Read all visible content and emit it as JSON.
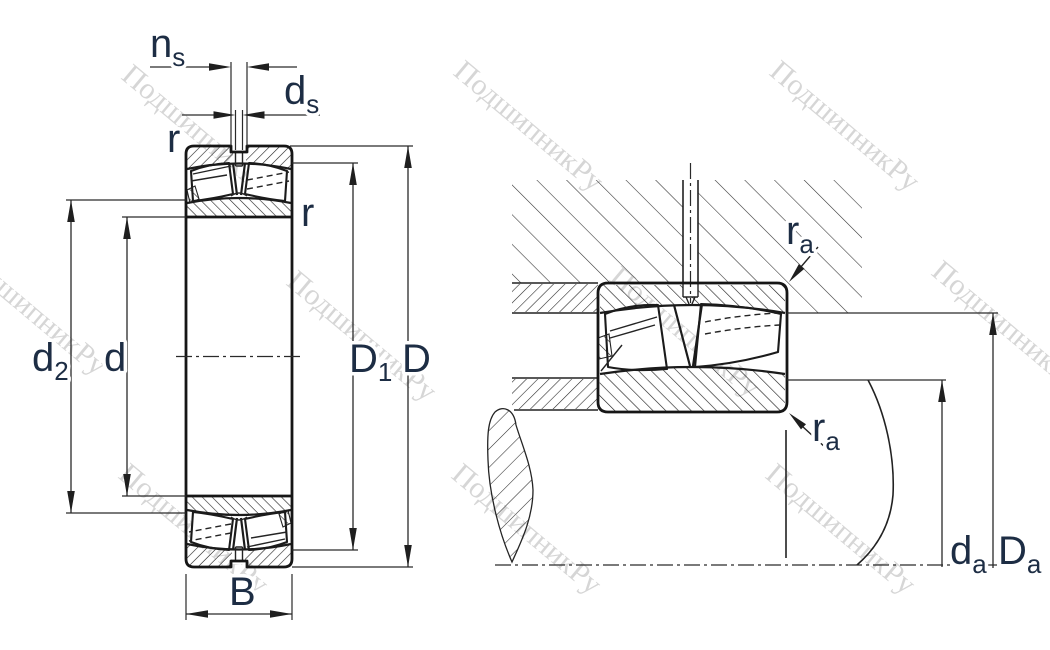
{
  "drawing": {
    "left_view": "bearing-cross-section",
    "right_view": "bearing-mounting-abutment"
  },
  "labels": {
    "ns": {
      "base": "n",
      "sub": "s"
    },
    "ds": {
      "base": "d",
      "sub": "s"
    },
    "r_outer": {
      "base": "r",
      "sub": ""
    },
    "r_inner": {
      "base": "r",
      "sub": ""
    },
    "d2": {
      "base": "d",
      "sub": "2"
    },
    "d": {
      "base": "d",
      "sub": ""
    },
    "D1": {
      "base": "D",
      "sub": "1"
    },
    "D": {
      "base": "D",
      "sub": ""
    },
    "B": {
      "base": "B",
      "sub": ""
    },
    "ra_upper": {
      "base": "r",
      "sub": "a"
    },
    "ra_lower": {
      "base": "r",
      "sub": "a"
    },
    "da": {
      "base": "d",
      "sub": "a"
    },
    "Da": {
      "base": "D",
      "sub": "a"
    }
  },
  "watermark": {
    "text": "ПодшипникРу"
  },
  "colors": {
    "line": "#1f1f1f",
    "label": "#1d2d44",
    "watermark": "#9a9a9a",
    "background": "#ffffff"
  }
}
